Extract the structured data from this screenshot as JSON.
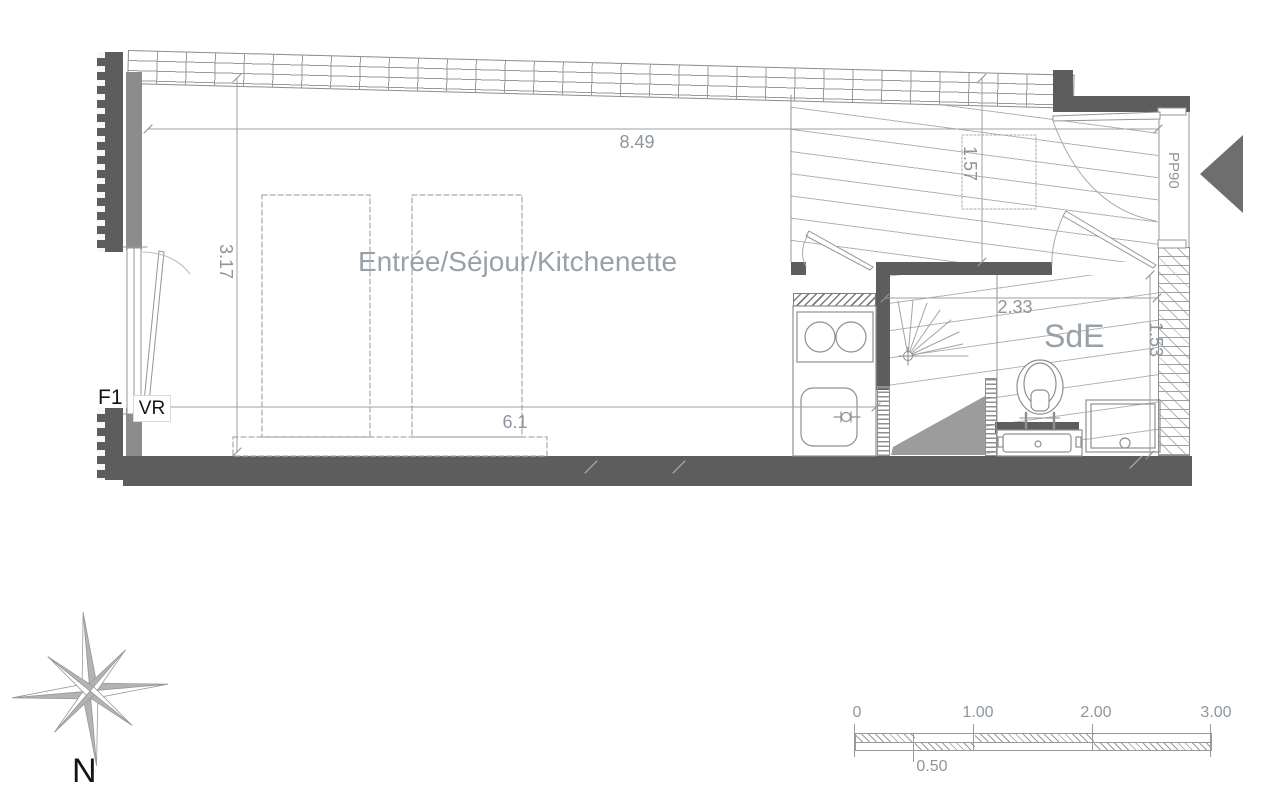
{
  "plan": {
    "unit_label": "F1",
    "roller_shutter_label": "VR",
    "entry_door_label": "PP90",
    "rooms": {
      "living": "Entrée/Séjour/Kitchenette",
      "bathroom": "SdE"
    },
    "dimensions": {
      "top_width": "8.49",
      "left_height": "3.17",
      "living_width": "6.1",
      "entry_depth": "1.57",
      "bathroom_width": "2.33",
      "bathroom_height": "1.53"
    }
  },
  "compass": {
    "north_label": "N"
  },
  "scale_bar": {
    "ticks": [
      "0",
      "1.00",
      "2.00",
      "3.00"
    ],
    "half_tick": "0.50"
  },
  "colors": {
    "wall": "#5d5d5d",
    "wall_inner": "#8c8c8c",
    "line": "#909090",
    "floor_hatch": "#b4b4b4",
    "dim_text": "#8e959d",
    "entry_arrow": "#6e6e6e",
    "label_dark": "#141414"
  }
}
